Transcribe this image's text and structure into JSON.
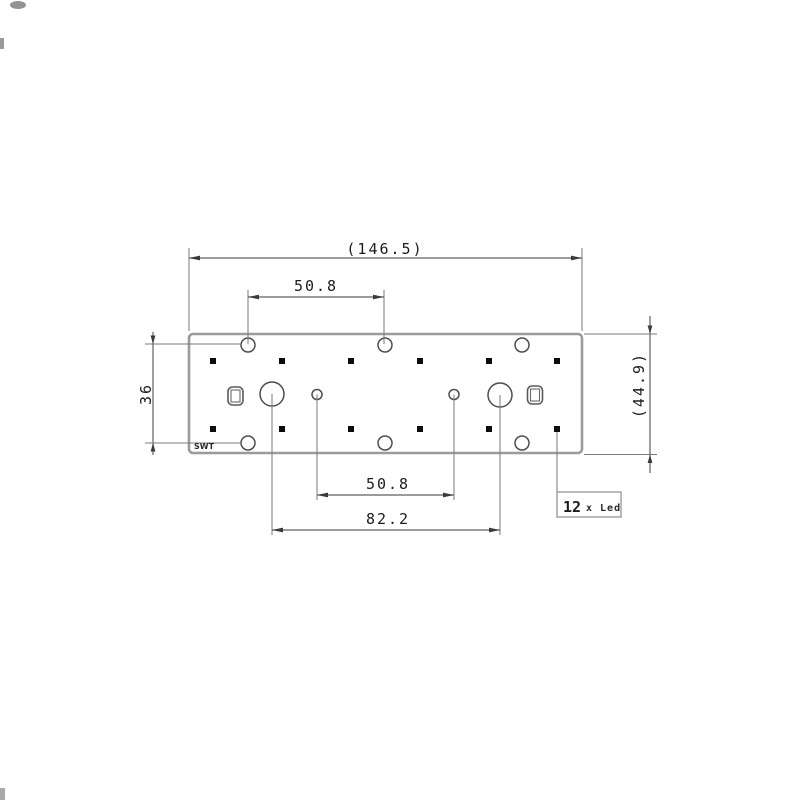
{
  "drawing": {
    "type": "mechanical-dimension-drawing",
    "board": {
      "marking": "SWT",
      "led_count": 12
    },
    "dimensions": {
      "overall_width": "(146.5)",
      "top_hole_spacing": "50.8",
      "left_height": "36",
      "right_overall_height": "(44.9)",
      "bottom_hole_spacing": "50.8",
      "bottom_large_hole_spacing": "82.2"
    },
    "callout": {
      "number": "12",
      "suffix": "x Led"
    },
    "colors": {
      "background": "#ffffff",
      "board_outline": "#9b9b9b",
      "dimension_line": "#5f5f5f",
      "hole_outline": "#4d4d4d",
      "led_fill": "#0c0c0c",
      "text": "#1c1c1c"
    }
  }
}
